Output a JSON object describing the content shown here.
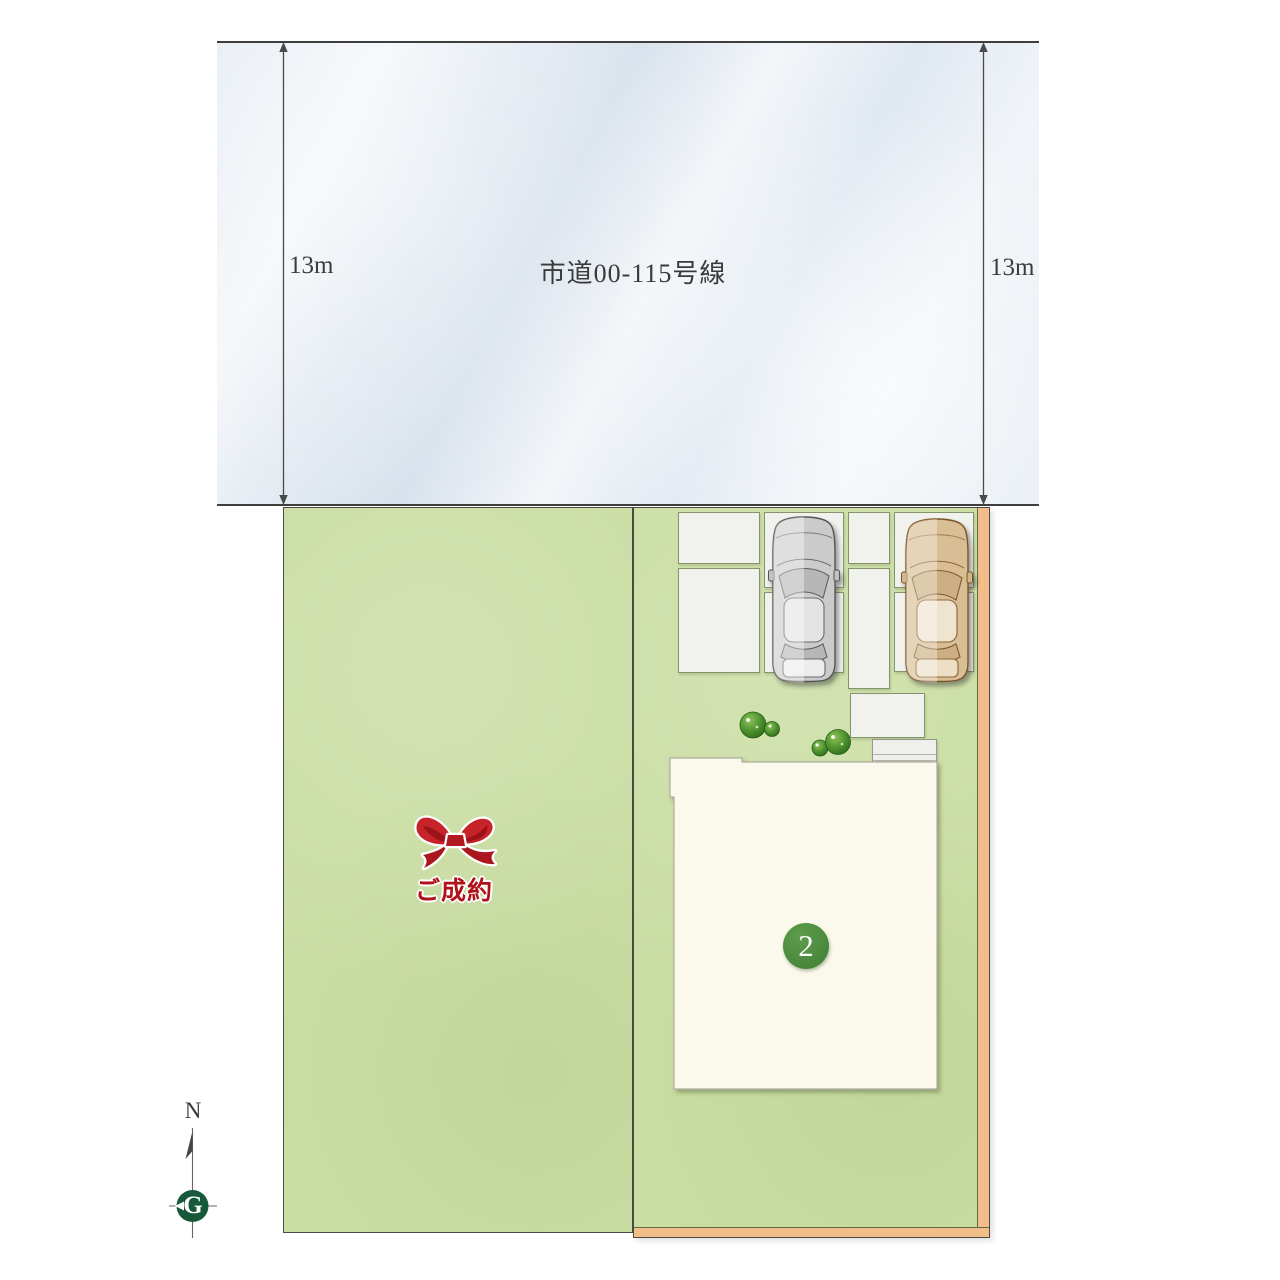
{
  "plan": {
    "road": {
      "name_label": "市道00-115号線"
    },
    "dimensions": {
      "left_label": "13m",
      "right_label": "13m"
    },
    "lot_sold": {
      "status_label": "ご成約"
    },
    "lot_active": {
      "number_label": "2"
    },
    "compass": {
      "north_label": "N",
      "center_label": "G"
    }
  },
  "colors": {
    "road_fill": "#e7edf3",
    "grass_green": "#cbdea4",
    "boundary_orange": "#f3bd8a",
    "house_cream": "#fbf9eb",
    "badge_green": "#4b8a3d",
    "ribbon_red": "#c6232a",
    "sold_text_red": "#b01218",
    "compass_green": "#15593a",
    "gray_car": "#cbcbcb",
    "beige_car": "#d9bd94"
  }
}
